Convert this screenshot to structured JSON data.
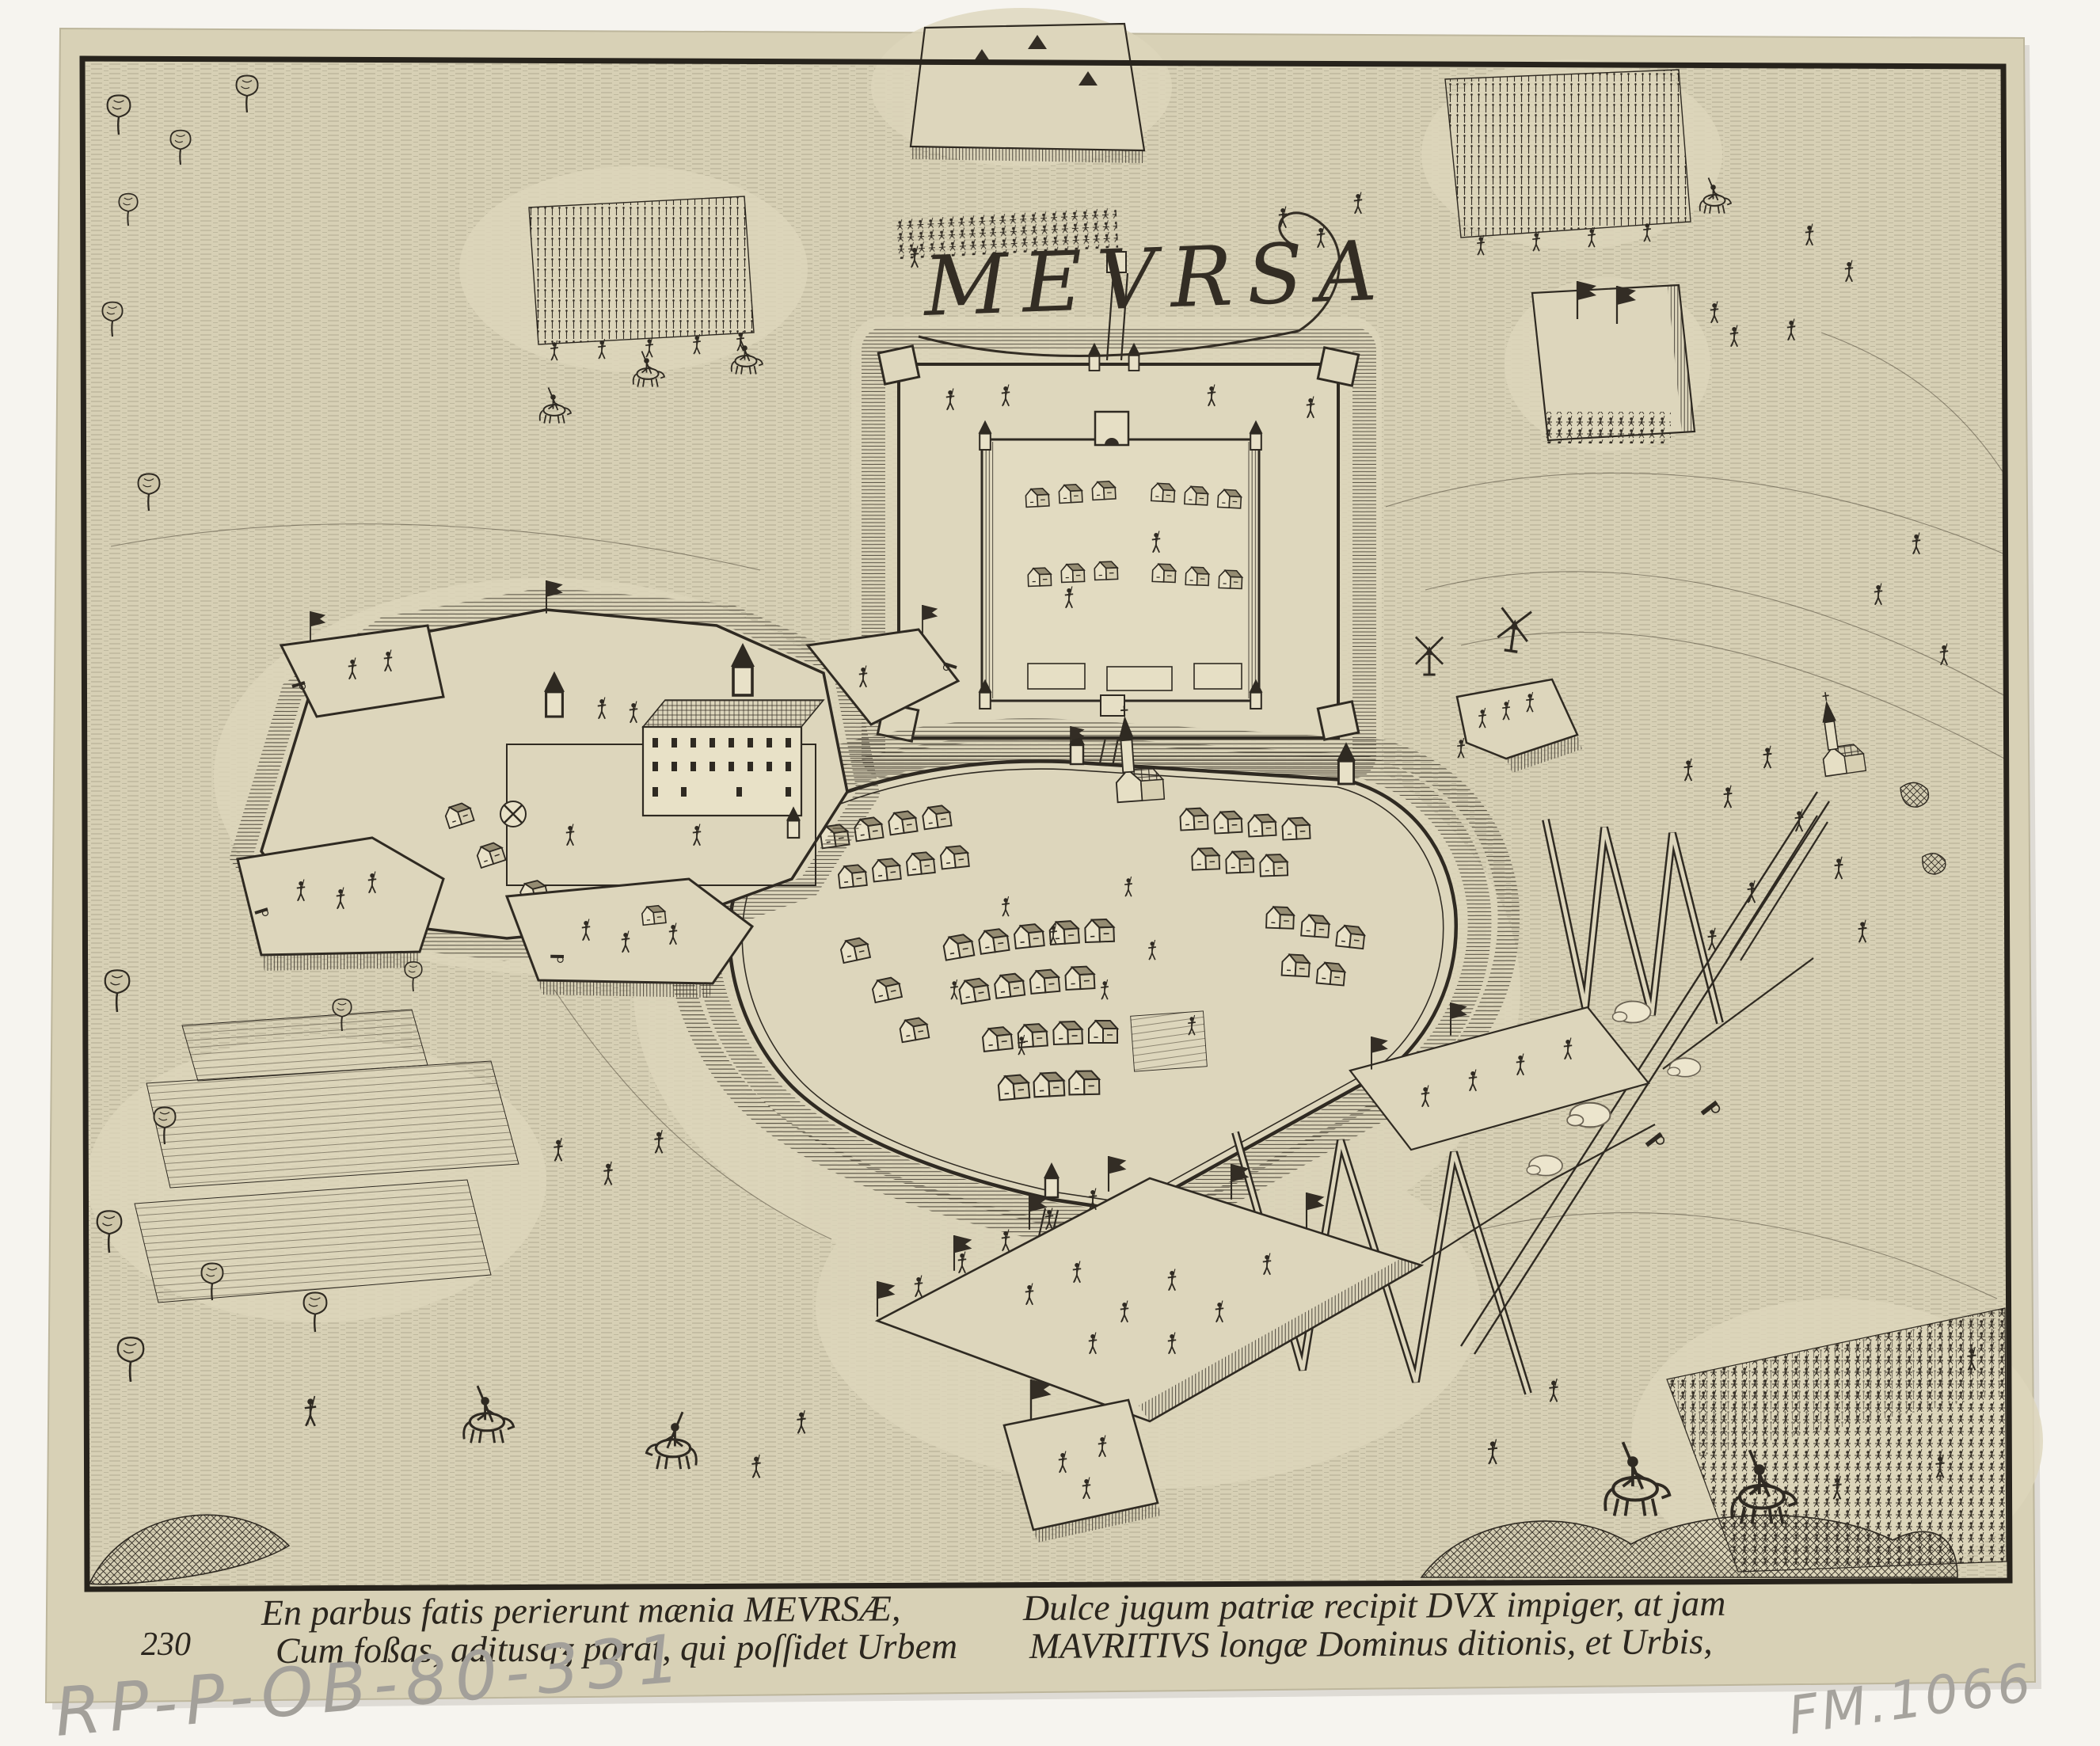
{
  "print": {
    "title_cartouche": "MEVRSA",
    "series_number": "230",
    "caption_left_line1": "En parbus fatis perierunt mænia MEVRSÆ,",
    "caption_left_line2": "Cum foßas, aditusqʒ parat, qui poſſidet Urbem",
    "caption_right_line1": "Dulce jugum patriæ recipit DVX impiger, at jam",
    "caption_right_line2": "MAVRITIVS longæ Dominus ditionis, et Urbis,"
  },
  "annotations": {
    "pencil_bottom_left": "RP-P-OB-80-331",
    "pencil_bottom_right": "FM.1066"
  },
  "colors": {
    "scan_background": "#f6f4ef",
    "paper": "#d8d1b6",
    "ink": "#2f2a22",
    "pencil": "#a3a09a"
  }
}
